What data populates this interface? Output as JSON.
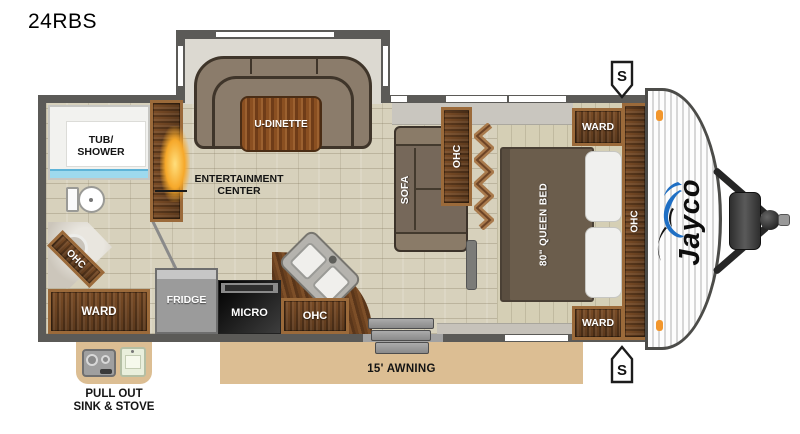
{
  "title": "24RBS",
  "plan": {
    "bathroom": {
      "tub_label_1": "TUB/",
      "tub_label_2": "SHOWER",
      "corner_cabinet": "OHC",
      "wardrobe": "WARD"
    },
    "living": {
      "entertainment_1": "ENTERTAINMENT",
      "entertainment_2": "CENTER",
      "dinette": "U-DINETTE",
      "sofa": "SOFA",
      "sofa_cabinet": "OHC"
    },
    "kitchen": {
      "fridge": "FRIDGE",
      "microwave": "MICRO",
      "cabinet": "OHC"
    },
    "bedroom": {
      "bed": "80\" QUEEN BED",
      "wardrobe_top": "WARD",
      "wardrobe_bottom": "WARD",
      "cabinet": "OHC"
    },
    "exterior": {
      "awning": "15' AWNING",
      "pullout_1": "PULL OUT",
      "pullout_2": "SINK & STOVE",
      "speaker": "S",
      "brand": "Jayco"
    }
  },
  "colors": {
    "wall": "#5b5a57",
    "floor": "#d7d1bc",
    "wood_frame": "#9b6a3a",
    "wood_dark": "#5a381c",
    "awning_tan": "#dcbe93",
    "water_blue": "#9ed9ee",
    "logo_blue": "#1f6fc4",
    "marker_orange": "#f2962c"
  }
}
